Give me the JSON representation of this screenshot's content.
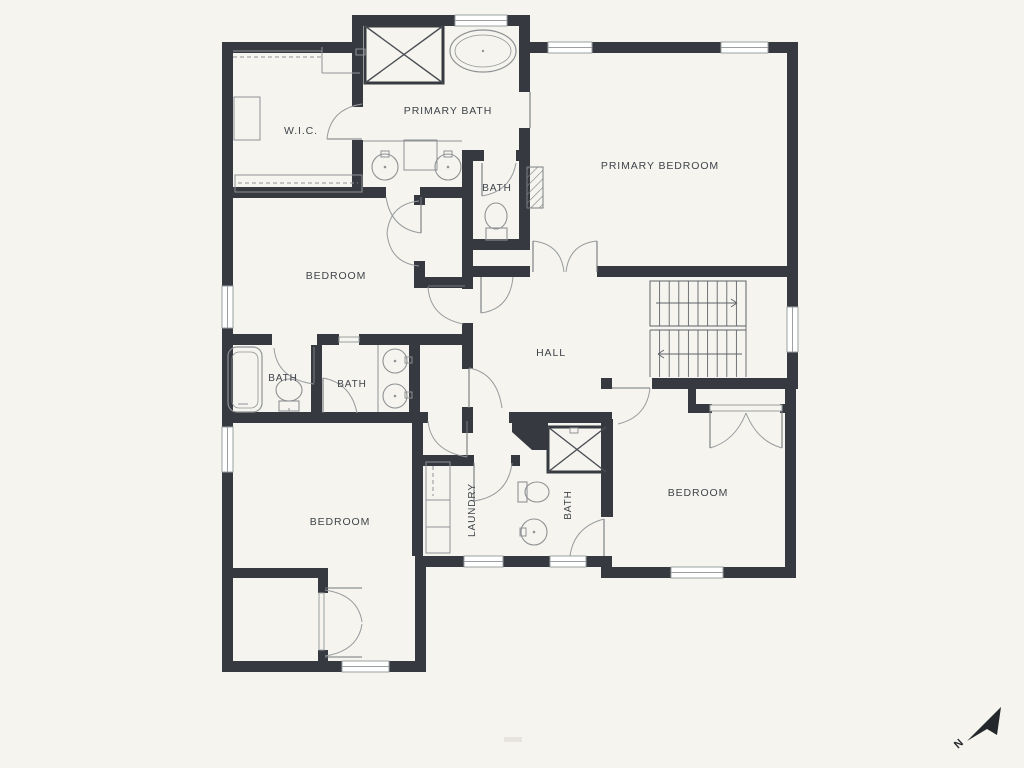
{
  "title": "floor-plan",
  "colors": {
    "background": "#f5f4ee",
    "wall": "#363a40",
    "thin": "#8f9295",
    "thin_dark": "#5f636a",
    "label": "#3f444b",
    "window_stroke": "#9aa0a3",
    "door": "#979b9e",
    "north": "#24272c"
  },
  "labels": [
    {
      "t": "W.I.C.",
      "x": 301,
      "y": 134,
      "s": 10.5,
      "r": 0
    },
    {
      "t": "PRIMARY BATH",
      "x": 448,
      "y": 114,
      "s": 10.5,
      "r": 0
    },
    {
      "t": "PRIMARY BEDROOM",
      "x": 660,
      "y": 169,
      "s": 10.5,
      "r": 0
    },
    {
      "t": "BATH",
      "x": 497,
      "y": 191,
      "s": 10,
      "r": 0
    },
    {
      "t": "BEDROOM",
      "x": 336,
      "y": 279,
      "s": 10.5,
      "r": 0
    },
    {
      "t": "HALL",
      "x": 551,
      "y": 356,
      "s": 10.5,
      "r": 0
    },
    {
      "t": "BATH",
      "x": 283,
      "y": 381,
      "s": 10,
      "r": 0
    },
    {
      "t": "BATH",
      "x": 352,
      "y": 387,
      "s": 10,
      "r": 0
    },
    {
      "t": "BEDROOM",
      "x": 340,
      "y": 525,
      "s": 10.5,
      "r": 0
    },
    {
      "t": "LAUNDRY",
      "x": 475,
      "y": 510,
      "s": 10,
      "r": -90
    },
    {
      "t": "BATH",
      "x": 571,
      "y": 505,
      "s": 10,
      "r": -90
    },
    {
      "t": "BEDROOM",
      "x": 698,
      "y": 496,
      "s": 10.5,
      "r": 0
    }
  ],
  "north_label": "N",
  "walls": [
    [
      222,
      42,
      141,
      11
    ],
    [
      352,
      15,
      11,
      38
    ],
    [
      352,
      15,
      178,
      11
    ],
    [
      519,
      15,
      11,
      77
    ],
    [
      530,
      42,
      268,
      11
    ],
    [
      787,
      42,
      11,
      347
    ],
    [
      785,
      385,
      11,
      193
    ],
    [
      612,
      567,
      184,
      11
    ],
    [
      601,
      556,
      11,
      22
    ],
    [
      415,
      556,
      197,
      11
    ],
    [
      415,
      556,
      11,
      116
    ],
    [
      222,
      661,
      204,
      11
    ],
    [
      222,
      42,
      11,
      630
    ],
    [
      352,
      42,
      11,
      65
    ],
    [
      352,
      140,
      11,
      58
    ],
    [
      222,
      187,
      164,
      11
    ],
    [
      420,
      187,
      46,
      11
    ],
    [
      462,
      150,
      22,
      11
    ],
    [
      516,
      150,
      14,
      11
    ],
    [
      519,
      128,
      11,
      122
    ],
    [
      462,
      239,
      68,
      11
    ],
    [
      462,
      150,
      11,
      127
    ],
    [
      462,
      266,
      68,
      11
    ],
    [
      597,
      266,
      201,
      11
    ],
    [
      414,
      195,
      11,
      10
    ],
    [
      414,
      261,
      11,
      16
    ],
    [
      414,
      277,
      59,
      11
    ],
    [
      462,
      277,
      11,
      12
    ],
    [
      462,
      323,
      11,
      46
    ],
    [
      462,
      407,
      11,
      26
    ],
    [
      222,
      334,
      50,
      11
    ],
    [
      317,
      334,
      22,
      11
    ],
    [
      359,
      334,
      103,
      11
    ],
    [
      311,
      345,
      11,
      67
    ],
    [
      409,
      345,
      11,
      67
    ],
    [
      222,
      412,
      206,
      11
    ],
    [
      466,
      412,
      7,
      11
    ],
    [
      412,
      423,
      11,
      133
    ],
    [
      412,
      455,
      62,
      11
    ],
    [
      511,
      455,
      9,
      11
    ],
    [
      509,
      412,
      103,
      11
    ],
    [
      601,
      419,
      12,
      98
    ],
    [
      601,
      378,
      11,
      11
    ],
    [
      652,
      378,
      146,
      11
    ],
    [
      688,
      385,
      8,
      28
    ],
    [
      696,
      404,
      16,
      9
    ],
    [
      780,
      404,
      10,
      9
    ],
    [
      233,
      568,
      95,
      10
    ],
    [
      318,
      568,
      10,
      25
    ],
    [
      318,
      650,
      10,
      22
    ]
  ],
  "wedge": [
    [
      512,
      419
    ],
    [
      548,
      419
    ],
    [
      548,
      450
    ],
    [
      532,
      450
    ],
    [
      512,
      432
    ]
  ],
  "hatch": {
    "x": 527,
    "y": 167,
    "w": 16,
    "h": 41
  },
  "windows": [
    [
      455,
      15,
      52,
      11
    ],
    [
      548,
      42,
      44,
      11
    ],
    [
      721,
      42,
      47,
      11
    ],
    [
      787,
      307,
      11,
      45
    ],
    [
      671,
      567,
      52,
      11
    ],
    [
      464,
      556,
      39,
      11
    ],
    [
      550,
      556,
      36,
      11
    ],
    [
      342,
      661,
      47,
      11
    ],
    [
      222,
      286,
      11,
      42
    ],
    [
      222,
      427,
      11,
      45
    ]
  ],
  "thresholds": [
    [
      339,
      337,
      20,
      5
    ],
    [
      710,
      405,
      72,
      6
    ],
    [
      319,
      593,
      5,
      57
    ]
  ],
  "doors": [
    {
      "l": [
        327,
        139,
        362,
        139
      ],
      "a": [
        327,
        139,
        330,
        109,
        362,
        104
      ]
    },
    {
      "l": [
        530,
        92,
        530,
        128
      ],
      "a": null
    },
    {
      "l": [
        482,
        163,
        482,
        196
      ],
      "a": [
        482,
        196,
        511,
        191,
        516,
        163
      ]
    },
    {
      "l": [
        481,
        277,
        481,
        313
      ],
      "a": [
        481,
        313,
        510,
        309,
        513,
        277
      ]
    },
    {
      "l": [
        533,
        241,
        533,
        272
      ],
      "a": [
        533,
        241,
        561,
        244,
        564,
        272
      ]
    },
    {
      "l": [
        597,
        241,
        597,
        272
      ],
      "a": [
        597,
        241,
        569,
        244,
        566,
        272
      ]
    },
    {
      "l": [
        421,
        197,
        421,
        233
      ],
      "a": [
        421,
        233,
        391,
        229,
        386,
        197
      ]
    },
    {
      "l": null,
      "a": [
        419,
        201,
        390,
        204,
        387,
        233
      ]
    },
    {
      "l": null,
      "a": [
        419,
        266,
        390,
        263,
        387,
        233
      ]
    },
    {
      "l": [
        428,
        286,
        465,
        286
      ],
      "a": [
        428,
        287,
        430,
        317,
        463,
        324
      ]
    },
    {
      "l": [
        314,
        347,
        314,
        383
      ],
      "a": [
        274,
        348,
        277,
        379,
        314,
        384
      ]
    },
    {
      "l": [
        323,
        378,
        323,
        413
      ],
      "a": [
        323,
        378,
        351,
        383,
        357,
        413
      ]
    },
    {
      "l": [
        469,
        368,
        469,
        408
      ],
      "a": [
        469,
        368,
        497,
        373,
        502,
        408
      ]
    },
    {
      "l": [
        467,
        421,
        467,
        457
      ],
      "a": [
        428,
        421,
        431,
        451,
        467,
        457
      ]
    },
    {
      "l": [
        474,
        463,
        474,
        501
      ],
      "a": [
        512,
        463,
        508,
        496,
        474,
        501
      ]
    },
    {
      "l": [
        604,
        519,
        604,
        556
      ],
      "a": [
        570,
        556,
        574,
        527,
        604,
        519
      ]
    },
    {
      "l": [
        612,
        388,
        650,
        388
      ],
      "a": [
        650,
        388,
        647,
        417,
        618,
        424
      ]
    },
    {
      "l": [
        710,
        412,
        710,
        448
      ],
      "a": [
        710,
        448,
        735,
        441,
        746,
        413
      ]
    },
    {
      "l": [
        782,
        412,
        782,
        448
      ],
      "a": [
        782,
        448,
        757,
        441,
        746,
        413
      ]
    },
    {
      "l": [
        325,
        588,
        362,
        588
      ],
      "a": [
        325,
        590,
        358,
        595,
        362,
        622
      ]
    },
    {
      "l": [
        325,
        657,
        362,
        657
      ],
      "a": [
        325,
        656,
        358,
        651,
        362,
        624
      ]
    }
  ],
  "showers": [
    {
      "x": 365,
      "y": 26,
      "w": 78,
      "h": 57
    },
    {
      "x": 548,
      "y": 427,
      "w": 58,
      "h": 45
    }
  ],
  "tub_oval": {
    "cx": 483,
    "cy": 51,
    "rx": 33,
    "ry": 21,
    "irx": 28,
    "iry": 16
  },
  "tub_rect": {
    "x": 228,
    "y": 347,
    "w": 34,
    "h": 65,
    "ix": 232,
    "iy": 352,
    "iw": 26,
    "ih": 56
  },
  "toilets": [
    {
      "bx": 486,
      "by": 228,
      "bw": 21,
      "bh": 12,
      "cx": 496,
      "cy": 216,
      "rx": 11,
      "ry": 13
    },
    {
      "bx": 279,
      "by": 401,
      "bw": 20,
      "bh": 10,
      "cx": 289,
      "cy": 390,
      "rx": 13,
      "ry": 11
    },
    {
      "bx": 518,
      "by": 482,
      "bw": 9,
      "bh": 20,
      "cx": 537,
      "cy": 492,
      "rx": 12,
      "ry": 10
    }
  ],
  "sinks": [
    {
      "cx": 385,
      "cy": 167,
      "r": 13
    },
    {
      "cx": 448,
      "cy": 167,
      "r": 13
    },
    {
      "cx": 395,
      "cy": 361,
      "r": 12
    },
    {
      "cx": 395,
      "cy": 396,
      "r": 12
    },
    {
      "cx": 534,
      "cy": 532,
      "r": 13
    }
  ],
  "small_rects": [
    [
      404,
      140,
      33,
      30
    ],
    [
      426,
      462,
      24,
      38
    ],
    [
      426,
      500,
      24,
      27
    ],
    [
      426,
      527,
      24,
      26
    ],
    [
      234,
      97,
      26,
      43
    ],
    [
      235,
      175,
      127,
      17
    ],
    [
      381,
      151,
      8,
      6
    ],
    [
      444,
      151,
      8,
      6
    ],
    [
      405,
      357,
      7,
      6
    ],
    [
      405,
      392,
      7,
      6
    ],
    [
      520,
      528,
      6,
      8
    ],
    [
      356,
      49,
      9,
      6
    ],
    [
      570,
      428,
      8,
      5
    ]
  ],
  "dashes": [
    [
      233,
      57,
      322,
      57
    ],
    [
      238,
      183,
      358,
      183
    ],
    [
      433,
      466,
      433,
      496
    ]
  ],
  "lines": [
    [
      363,
      141,
      462,
      141
    ],
    [
      378,
      345,
      378,
      412
    ],
    [
      233,
      51,
      322,
      51
    ],
    [
      322,
      47,
      322,
      73
    ],
    [
      322,
      73,
      360,
      73
    ],
    [
      238,
      404,
      248,
      404
    ],
    [
      289,
      408,
      289,
      411
    ]
  ],
  "stairs": {
    "box": [
      650,
      281,
      96,
      45
    ],
    "tread_x0": 659.6,
    "tread_dx": 9.6,
    "tread_n": 9,
    "upper_y": [
      281,
      326
    ],
    "lower_y": [
      330,
      377
    ],
    "divider": [
      [
        650,
        326,
        746,
        326
      ],
      [
        650,
        330,
        746,
        330
      ]
    ],
    "sides": [
      [
        650,
        330,
        650,
        377
      ],
      [
        746,
        281,
        746,
        377
      ]
    ],
    "arrow_up": [
      656,
      303,
      737,
      303
    ],
    "arrow_dn": [
      742,
      354,
      658,
      354
    ]
  },
  "north": {
    "poly": [
      [
        1001,
        707
      ],
      [
        967,
        741
      ],
      [
        987,
        729
      ],
      [
        997,
        735
      ]
    ],
    "nx": 958,
    "ny": 749,
    "nr": -42
  },
  "faint_mark": {
    "x": 504,
    "y": 737,
    "w": 18,
    "h": 5
  }
}
